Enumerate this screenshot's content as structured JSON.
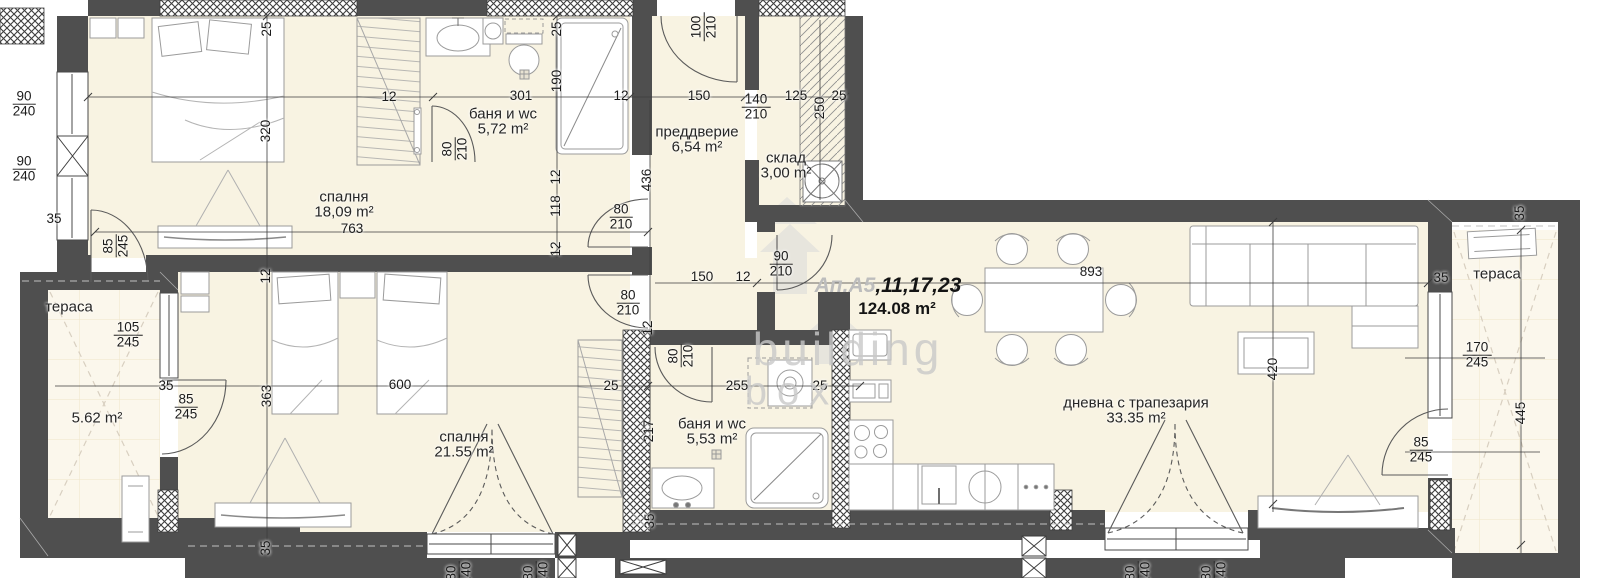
{
  "plan": {
    "colors": {
      "wall": "#4f4f4f",
      "floor": "#f8f3e2",
      "terrace": "#fbf7ec",
      "dim_text": "#1b1b1b",
      "watermark": "#c9c9c9"
    },
    "watermark": {
      "line1": "building",
      "line2": "box"
    }
  },
  "apartment": {
    "label_gray": "Ап.А5",
    "label_black": ",11,17,23",
    "total_area": "124.08 m²"
  },
  "rooms": [
    {
      "id": "bedroom-1",
      "name": "спалня",
      "area": "18,09 m²",
      "x": 344,
      "y": 205
    },
    {
      "id": "bathroom-1",
      "name": "баня и wc",
      "area": "5,72 m²",
      "x": 503,
      "y": 122
    },
    {
      "id": "entry-hall",
      "name": "преддверие",
      "area": "6,54 m²",
      "x": 697,
      "y": 140
    },
    {
      "id": "storage",
      "name": "склад",
      "area": "3,00 m²",
      "x": 786,
      "y": 166
    },
    {
      "id": "bedroom-2",
      "name": "спалня",
      "area": "21.55 m²",
      "x": 464,
      "y": 445
    },
    {
      "id": "bathroom-2",
      "name": "баня и wc",
      "area": "5,53 m²",
      "x": 712,
      "y": 432
    },
    {
      "id": "living-dining",
      "name": "дневна с трапезария",
      "area": "33.35 m²",
      "x": 1136,
      "y": 411
    },
    {
      "id": "terrace-left",
      "name": "тераса",
      "area": "5.62 m²",
      "x": 69,
      "y": 307,
      "area_x": 97,
      "area_y": 418
    },
    {
      "id": "terrace-right",
      "name": "тераса",
      "area": "",
      "x": 1497,
      "y": 274
    }
  ],
  "dimensions": [
    {
      "t": "35",
      "x": 54,
      "y": 219,
      "r": 0
    },
    {
      "t": "25",
      "x": 267,
      "y": 29,
      "r": 1
    },
    {
      "t": "320",
      "x": 266,
      "y": 131,
      "r": 1
    },
    {
      "t": "12",
      "x": 389,
      "y": 97,
      "r": 0
    },
    {
      "t": "301",
      "x": 521,
      "y": 96,
      "r": 0
    },
    {
      "t": "25",
      "x": 557,
      "y": 29,
      "r": 1
    },
    {
      "t": "190",
      "x": 557,
      "y": 81,
      "r": 1
    },
    {
      "t": "12",
      "x": 621,
      "y": 96,
      "r": 0
    },
    {
      "t": "12",
      "x": 556,
      "y": 177,
      "r": 1
    },
    {
      "t": "118",
      "x": 556,
      "y": 206,
      "r": 1
    },
    {
      "t": "12",
      "x": 556,
      "y": 249,
      "r": 1
    },
    {
      "t": "436",
      "x": 647,
      "y": 180,
      "r": 1
    },
    {
      "t": "150",
      "x": 699,
      "y": 96,
      "r": 0
    },
    {
      "t": "125",
      "x": 796,
      "y": 96,
      "r": 0
    },
    {
      "t": "25",
      "x": 839,
      "y": 96,
      "r": 0
    },
    {
      "t": "250",
      "x": 820,
      "y": 108,
      "r": 1
    },
    {
      "t": "150",
      "x": 702,
      "y": 277,
      "r": 0
    },
    {
      "t": "12",
      "x": 743,
      "y": 277,
      "r": 0
    },
    {
      "t": "763",
      "x": 352,
      "y": 229,
      "r": 0
    },
    {
      "t": "600",
      "x": 400,
      "y": 385,
      "r": 0
    },
    {
      "t": "363",
      "x": 267,
      "y": 396,
      "r": 1
    },
    {
      "t": "12",
      "x": 266,
      "y": 276,
      "r": 1
    },
    {
      "t": "35",
      "x": 266,
      "y": 548,
      "r": 1
    },
    {
      "t": "35",
      "x": 166,
      "y": 386,
      "r": 0
    },
    {
      "t": "25",
      "x": 611,
      "y": 386,
      "r": 0
    },
    {
      "t": "255",
      "x": 737,
      "y": 386,
      "r": 0
    },
    {
      "t": "25",
      "x": 820,
      "y": 386,
      "r": 0
    },
    {
      "t": "12",
      "x": 648,
      "y": 328,
      "r": 1
    },
    {
      "t": "217",
      "x": 649,
      "y": 431,
      "r": 1
    },
    {
      "t": "35",
      "x": 650,
      "y": 521,
      "r": 1
    },
    {
      "t": "893",
      "x": 1091,
      "y": 272,
      "r": 0
    },
    {
      "t": "420",
      "x": 1273,
      "y": 369,
      "r": 1
    },
    {
      "t": "35",
      "x": 1441,
      "y": 278,
      "r": 0
    },
    {
      "t": "35",
      "x": 1520,
      "y": 213,
      "r": 1
    },
    {
      "t": "445",
      "x": 1521,
      "y": 413,
      "r": 1
    }
  ],
  "door_window_sizes": [
    {
      "w": "90",
      "h": "240",
      "x": 24,
      "y": 104,
      "r": 0
    },
    {
      "w": "90",
      "h": "240",
      "x": 24,
      "y": 169,
      "r": 0
    },
    {
      "w": "85",
      "h": "245",
      "x": 116,
      "y": 246,
      "r": 1
    },
    {
      "w": "80",
      "h": "210",
      "x": 455,
      "y": 149,
      "r": 1
    },
    {
      "w": "100",
      "h": "210",
      "x": 704,
      "y": 27,
      "r": 1
    },
    {
      "w": "140",
      "h": "210",
      "x": 756,
      "y": 107,
      "r": 0
    },
    {
      "w": "80",
      "h": "210",
      "x": 621,
      "y": 217,
      "r": 0
    },
    {
      "w": "80",
      "h": "210",
      "x": 628,
      "y": 303,
      "r": 0
    },
    {
      "w": "80",
      "h": "210",
      "x": 681,
      "y": 356,
      "r": 1
    },
    {
      "w": "90",
      "h": "210",
      "x": 781,
      "y": 264,
      "r": 0
    },
    {
      "w": "105",
      "h": "245",
      "x": 128,
      "y": 335,
      "r": 0
    },
    {
      "w": "85",
      "h": "245",
      "x": 186,
      "y": 407,
      "r": 0
    },
    {
      "w": "170",
      "h": "245",
      "x": 1477,
      "y": 355,
      "r": 0
    },
    {
      "w": "85",
      "h": "245",
      "x": 1421,
      "y": 450,
      "r": 0
    },
    {
      "w": "80",
      "h": "140",
      "x": 459,
      "y": 573,
      "r": 1
    },
    {
      "w": "80",
      "h": "140",
      "x": 536,
      "y": 573,
      "r": 1
    },
    {
      "w": "80",
      "h": "140",
      "x": 1138,
      "y": 573,
      "r": 1
    },
    {
      "w": "80",
      "h": "140",
      "x": 1214,
      "y": 573,
      "r": 1
    }
  ]
}
